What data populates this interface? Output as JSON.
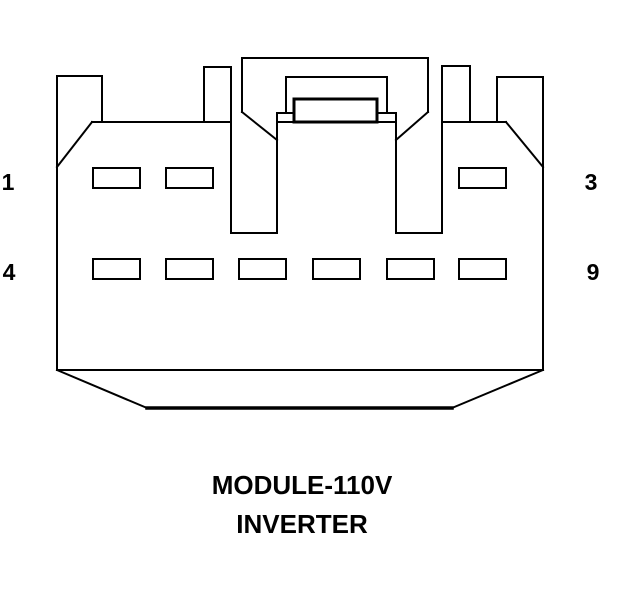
{
  "page": {
    "background": "#ffffff",
    "line_color": "#000000"
  },
  "diagram": {
    "type": "connector-pinout",
    "caption": {
      "line1": "MODULE-110V",
      "line2": "INVERTER"
    },
    "pins": {
      "row1": {
        "left_label": "1",
        "right_label": "3",
        "slot_count": 3
      },
      "row2": {
        "left_label": "4",
        "right_label": "9",
        "slot_count": 6
      }
    }
  }
}
